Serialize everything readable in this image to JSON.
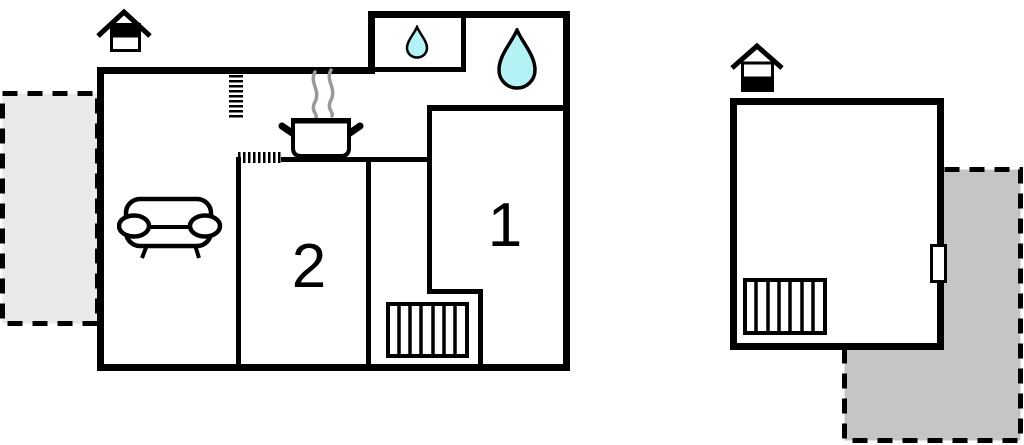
{
  "floorplan": {
    "title": "apartment-floorplan",
    "background": "#ffffff",
    "wall_color": "#000000",
    "rooms": [
      {
        "label": "1"
      },
      {
        "label": "2"
      }
    ],
    "symbols": {
      "water_color": "#b5f2f6",
      "steam_color": "#999999",
      "icons": [
        "floor-level-house-icon-upper",
        "floor-level-house-icon-lower",
        "sofa-icon",
        "stove-pot-icon",
        "water-drop-small-icon",
        "water-drop-large-icon",
        "stairs-icon-main",
        "stairs-icon-annex",
        "door-opening-hatch-vertical",
        "door-opening-hatch-horizontal",
        "window-door-white-rect"
      ]
    },
    "terraces": {
      "left_fill": "#e9e9e9",
      "right_fill": "#c5c5c5",
      "border_style": "dashed"
    }
  }
}
